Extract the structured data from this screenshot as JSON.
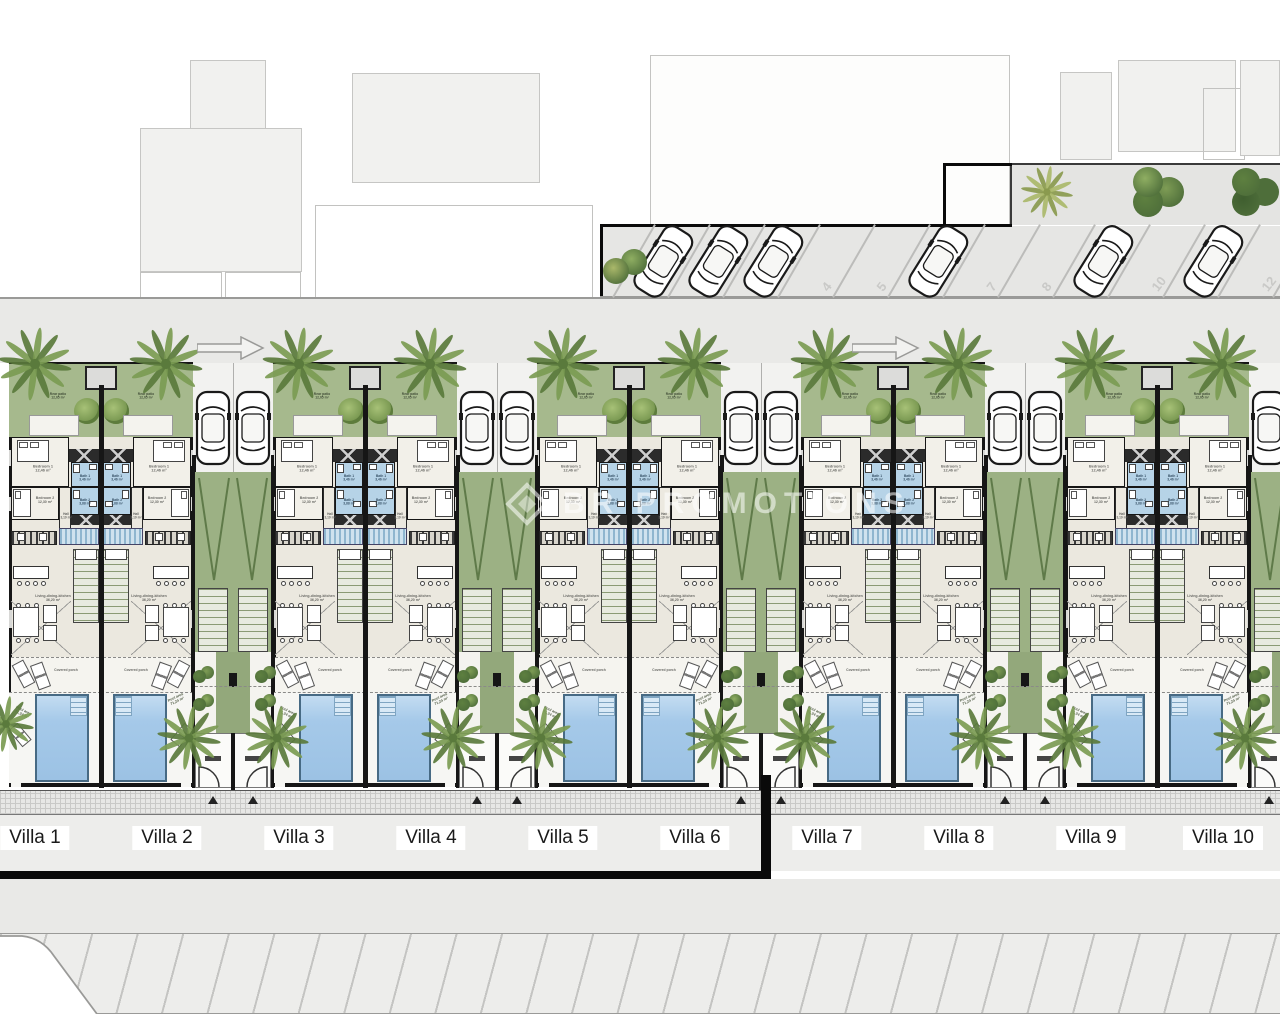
{
  "watermark": {
    "text": "BR PROMOTIONS"
  },
  "villas": [
    {
      "name": "Villa 1"
    },
    {
      "name": "Villa 2"
    },
    {
      "name": "Villa 3"
    },
    {
      "name": "Villa 4"
    },
    {
      "name": "Villa 5"
    },
    {
      "name": "Villa 6"
    },
    {
      "name": "Villa 7"
    },
    {
      "name": "Villa 8"
    },
    {
      "name": "Villa 9"
    },
    {
      "name": "Villa 10"
    }
  ],
  "parking": {
    "slots": [
      {
        "car": true,
        "label": ""
      },
      {
        "car": true,
        "label": ""
      },
      {
        "car": true,
        "label": ""
      },
      {
        "car": false,
        "label": "4"
      },
      {
        "car": false,
        "label": "5"
      },
      {
        "car": true,
        "label": ""
      },
      {
        "car": false,
        "label": "7"
      },
      {
        "car": false,
        "label": "8"
      },
      {
        "car": true,
        "label": ""
      },
      {
        "car": false,
        "label": "10"
      },
      {
        "car": true,
        "label": ""
      },
      {
        "car": false,
        "label": "12"
      }
    ]
  },
  "labels": {
    "rear_patio": "Rear patio\n12,05 m²",
    "bedroom1": "Bedroom 1\n12,46 m²",
    "bedroom2": "Bedroom 2\n12,30 m²",
    "bath1": "Bath 1\n3,46 m²",
    "bath2": "Bath 2\n3,88 m²",
    "hall": "Hall\n3,19 m²",
    "living": "Living-dining-kitchen\n36,20 m²",
    "covered_porch": "Covered porch",
    "pool_area": "Pool area\n71,24 m²"
  },
  "colors": {
    "patio_green": "#a6b98d",
    "driveway_green": "#9cb184",
    "bath_blue": "#b6d3e7",
    "pool_water": "#a5c9e9",
    "wall": "#161616",
    "road": "#e9e9e7"
  }
}
